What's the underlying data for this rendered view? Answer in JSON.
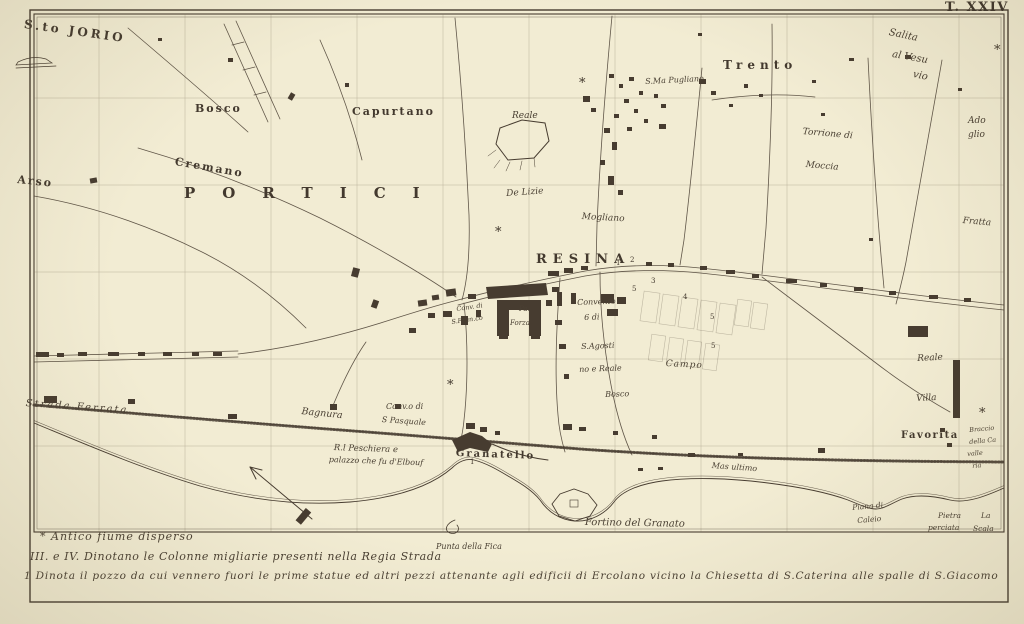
{
  "plate": "T. XXIV",
  "legend": {
    "lines": [
      "* Antico fiume disperso",
      "III. e IV. Dinotano le Colonne migliarie presenti nella Regia Strada",
      "1 Dinota il pozzo da cui vennero fuori le prime statue ed altri pezzi attenante agli edificii di Ercolano vicino la Chiesetta di S.Caterina alle spalle di S.Giacomo"
    ]
  },
  "map": {
    "ink_color": "#473c30",
    "paper_color": "#f2ecd3",
    "labels": [
      {
        "t": "S.to JORIO",
        "x": 25,
        "y": 18,
        "s": 12,
        "ls": 3,
        "r": 8,
        "b": 1
      },
      {
        "t": "Bosco",
        "x": 195,
        "y": 103,
        "s": 11,
        "ls": 2,
        "r": 0,
        "b": 1
      },
      {
        "t": "Capurtano",
        "x": 352,
        "y": 106,
        "s": 11,
        "ls": 2,
        "r": 0,
        "b": 1
      },
      {
        "t": "Cremano",
        "x": 176,
        "y": 156,
        "s": 11,
        "ls": 2,
        "r": 10,
        "b": 1
      },
      {
        "t": "Arso",
        "x": 18,
        "y": 174,
        "s": 11,
        "ls": 2,
        "r": 6,
        "b": 1
      },
      {
        "t": "PORTICI",
        "x": 184,
        "y": 186,
        "s": 15,
        "ls": 27,
        "r": 0,
        "b": 1
      },
      {
        "t": "RESINA",
        "x": 536,
        "y": 253,
        "s": 13,
        "ls": 6,
        "r": 0,
        "b": 1
      },
      {
        "t": "Trento",
        "x": 723,
        "y": 59,
        "s": 12,
        "ls": 5,
        "r": 0,
        "b": 1
      },
      {
        "t": "Granatello",
        "x": 456,
        "y": 449,
        "s": 10,
        "ls": 2,
        "r": 2,
        "b": 1
      },
      {
        "t": "Favorita",
        "x": 901,
        "y": 431,
        "s": 10,
        "ls": 1.5,
        "r": 0,
        "b": 1
      },
      {
        "t": "S.Ma Pugliano",
        "x": 645,
        "y": 78,
        "s": 8,
        "r": -3,
        "i": 1
      },
      {
        "t": "Reale",
        "x": 512,
        "y": 112,
        "s": 9,
        "r": 0,
        "i": 1
      },
      {
        "t": "De Lizie",
        "x": 506,
        "y": 190,
        "s": 9,
        "r": -4,
        "i": 1
      },
      {
        "t": "Mogliano",
        "x": 582,
        "y": 213,
        "s": 9,
        "r": 3,
        "i": 1
      },
      {
        "t": "Torrione di",
        "x": 803,
        "y": 128,
        "s": 9,
        "r": 5,
        "i": 1
      },
      {
        "t": "Moccia",
        "x": 806,
        "y": 161,
        "s": 9,
        "r": 5,
        "i": 1
      },
      {
        "t": "Salita",
        "x": 890,
        "y": 28,
        "s": 10,
        "r": 12,
        "i": 1
      },
      {
        "t": "al Vesu",
        "x": 893,
        "y": 50,
        "s": 10,
        "r": 10,
        "i": 1
      },
      {
        "t": "vio",
        "x": 914,
        "y": 70,
        "s": 10,
        "r": 12,
        "i": 1
      },
      {
        "t": "Ado",
        "x": 968,
        "y": 117,
        "s": 9,
        "r": 0,
        "i": 1
      },
      {
        "t": "glio",
        "x": 968,
        "y": 131,
        "s": 9,
        "r": 0,
        "i": 1
      },
      {
        "t": "Fratta",
        "x": 963,
        "y": 217,
        "s": 9,
        "r": 5,
        "i": 1
      },
      {
        "t": "Reale",
        "x": 917,
        "y": 355,
        "s": 9,
        "r": -3,
        "i": 1
      },
      {
        "t": "Villa",
        "x": 916,
        "y": 395,
        "s": 9,
        "r": -3,
        "i": 1
      },
      {
        "t": "Braccio",
        "x": 969,
        "y": 427,
        "s": 6.5,
        "r": -5,
        "i": 1
      },
      {
        "t": "della Ca",
        "x": 969,
        "y": 439,
        "s": 6.5,
        "r": -5,
        "i": 1
      },
      {
        "t": "valle",
        "x": 967,
        "y": 451,
        "s": 6.5,
        "r": -5,
        "i": 1
      },
      {
        "t": "ria",
        "x": 972,
        "y": 463,
        "s": 6.5,
        "r": -5,
        "i": 1
      },
      {
        "t": "Strada Ferrata",
        "x": 26,
        "y": 399,
        "s": 10,
        "ls": 2,
        "r": 4,
        "i": 1
      },
      {
        "t": "Bagnura",
        "x": 302,
        "y": 407,
        "s": 9.5,
        "r": 6,
        "i": 1
      },
      {
        "t": "Conv.o di",
        "x": 386,
        "y": 403,
        "s": 8,
        "r": 0,
        "i": 1
      },
      {
        "t": "S Pasquale",
        "x": 382,
        "y": 416,
        "s": 8,
        "r": 4,
        "i": 1
      },
      {
        "t": "R.l Peschiera e",
        "x": 334,
        "y": 444,
        "s": 8.5,
        "r": 2,
        "i": 1
      },
      {
        "t": "palazzo che fu d'Elbouf",
        "x": 329,
        "y": 456,
        "s": 8,
        "r": 2,
        "i": 1
      },
      {
        "t": "Fortino del Granato",
        "x": 585,
        "y": 518,
        "s": 10,
        "r": 1,
        "i": 1
      },
      {
        "t": "Mas ultimo",
        "x": 712,
        "y": 462,
        "s": 8,
        "r": 4,
        "i": 1
      },
      {
        "t": "Punta della Fica",
        "x": 436,
        "y": 543,
        "s": 8,
        "r": 0,
        "i": 1
      },
      {
        "t": "Piana di",
        "x": 852,
        "y": 504,
        "s": 7.5,
        "r": -5,
        "i": 1
      },
      {
        "t": "Caleio",
        "x": 857,
        "y": 517,
        "s": 7.5,
        "r": -5,
        "i": 1
      },
      {
        "t": "Pietra",
        "x": 938,
        "y": 512,
        "s": 7.5,
        "r": 0,
        "i": 1
      },
      {
        "t": "perciata",
        "x": 928,
        "y": 524,
        "s": 7.5,
        "r": 0,
        "i": 1
      },
      {
        "t": "La",
        "x": 981,
        "y": 512,
        "s": 7.5,
        "r": 0,
        "i": 1
      },
      {
        "t": "Scala",
        "x": 973,
        "y": 525,
        "s": 7.5,
        "r": 0,
        "i": 1
      },
      {
        "t": "Convento",
        "x": 577,
        "y": 299,
        "s": 8,
        "r": -2,
        "i": 1
      },
      {
        "t": "6 di",
        "x": 584,
        "y": 314,
        "s": 8,
        "r": -2,
        "i": 1
      },
      {
        "t": "S.Agosti",
        "x": 581,
        "y": 343,
        "s": 8,
        "r": -2,
        "i": 1
      },
      {
        "t": "no e Reale",
        "x": 579,
        "y": 366,
        "s": 8,
        "r": -2,
        "i": 1
      },
      {
        "t": "Bosco",
        "x": 605,
        "y": 391,
        "s": 8,
        "r": -2,
        "i": 1
      },
      {
        "t": "Campo",
        "x": 666,
        "y": 360,
        "s": 9,
        "ls": 1,
        "r": 3,
        "i": 1
      },
      {
        "t": "Conv. di",
        "x": 456,
        "y": 306,
        "s": 6.5,
        "r": -8,
        "i": 1
      },
      {
        "t": "S.Fran.co",
        "x": 451,
        "y": 319,
        "s": 6.5,
        "r": -8,
        "i": 1
      },
      {
        "t": "Pa.",
        "x": 519,
        "y": 306,
        "s": 7,
        "r": 0,
        "i": 1
      },
      {
        "t": "Forza",
        "x": 510,
        "y": 320,
        "s": 7,
        "r": 0,
        "i": 1
      },
      {
        "t": "1",
        "x": 616,
        "y": 260,
        "s": 7
      },
      {
        "t": "2",
        "x": 630,
        "y": 257,
        "s": 7
      },
      {
        "t": "3",
        "x": 651,
        "y": 278,
        "s": 7
      },
      {
        "t": "5",
        "x": 632,
        "y": 286,
        "s": 7
      },
      {
        "t": "4",
        "x": 683,
        "y": 294,
        "s": 7
      },
      {
        "t": "5",
        "x": 710,
        "y": 314,
        "s": 7
      },
      {
        "t": "5",
        "x": 711,
        "y": 343,
        "s": 7
      },
      {
        "t": "1",
        "x": 470,
        "y": 459,
        "s": 7
      },
      {
        "t": "*",
        "x": 579,
        "y": 77,
        "s": 13
      },
      {
        "t": "*",
        "x": 994,
        "y": 44,
        "s": 13
      },
      {
        "t": "*",
        "x": 979,
        "y": 407,
        "s": 13
      },
      {
        "t": "*",
        "x": 495,
        "y": 226,
        "s": 13
      },
      {
        "t": "*",
        "x": 447,
        "y": 379,
        "s": 13
      }
    ]
  }
}
